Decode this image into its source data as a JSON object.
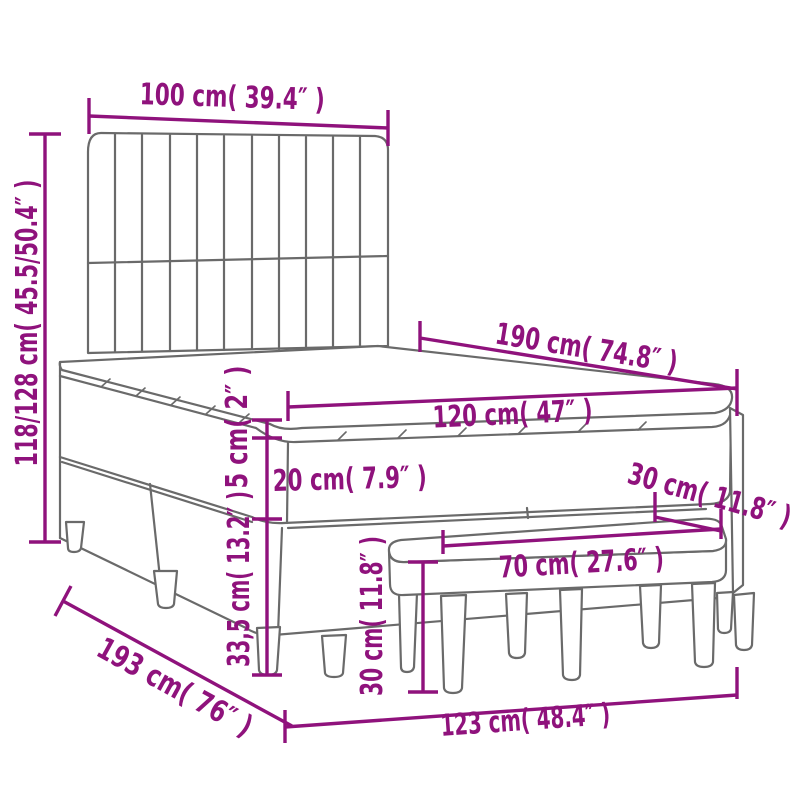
{
  "page": {
    "background": "#ffffff"
  },
  "colors": {
    "dimension_accent": "#8F127C",
    "line_art_gray": "#6A6A6A",
    "fill_white": "#FFFFFF"
  },
  "diagram": {
    "type": "product-dimension-diagram",
    "subject": "box spring bed with slatted headboard, mattress, topper and bench",
    "labels": {
      "headboard_width": "100 cm( 39.4″ )",
      "overall_height": "118/128 cm( 45.5/50.4″ )",
      "bed_length": "190 cm( 74.8″ )",
      "bed_width": "120 cm( 47″ )",
      "topper_thickness": "5 cm( 2″ )",
      "mattress_thickness": "20 cm( 7.9″ )",
      "base_height": "33,5 cm( 13.2″ )",
      "bench_seat_height": "30 cm( 11.8″ )",
      "bench_depth": "30 cm( 11.8″ )",
      "bench_width": "70 cm( 27.6″ )",
      "floor_length": "193 cm( 76″ )",
      "floor_width": "123 cm( 48.4″ )"
    }
  }
}
